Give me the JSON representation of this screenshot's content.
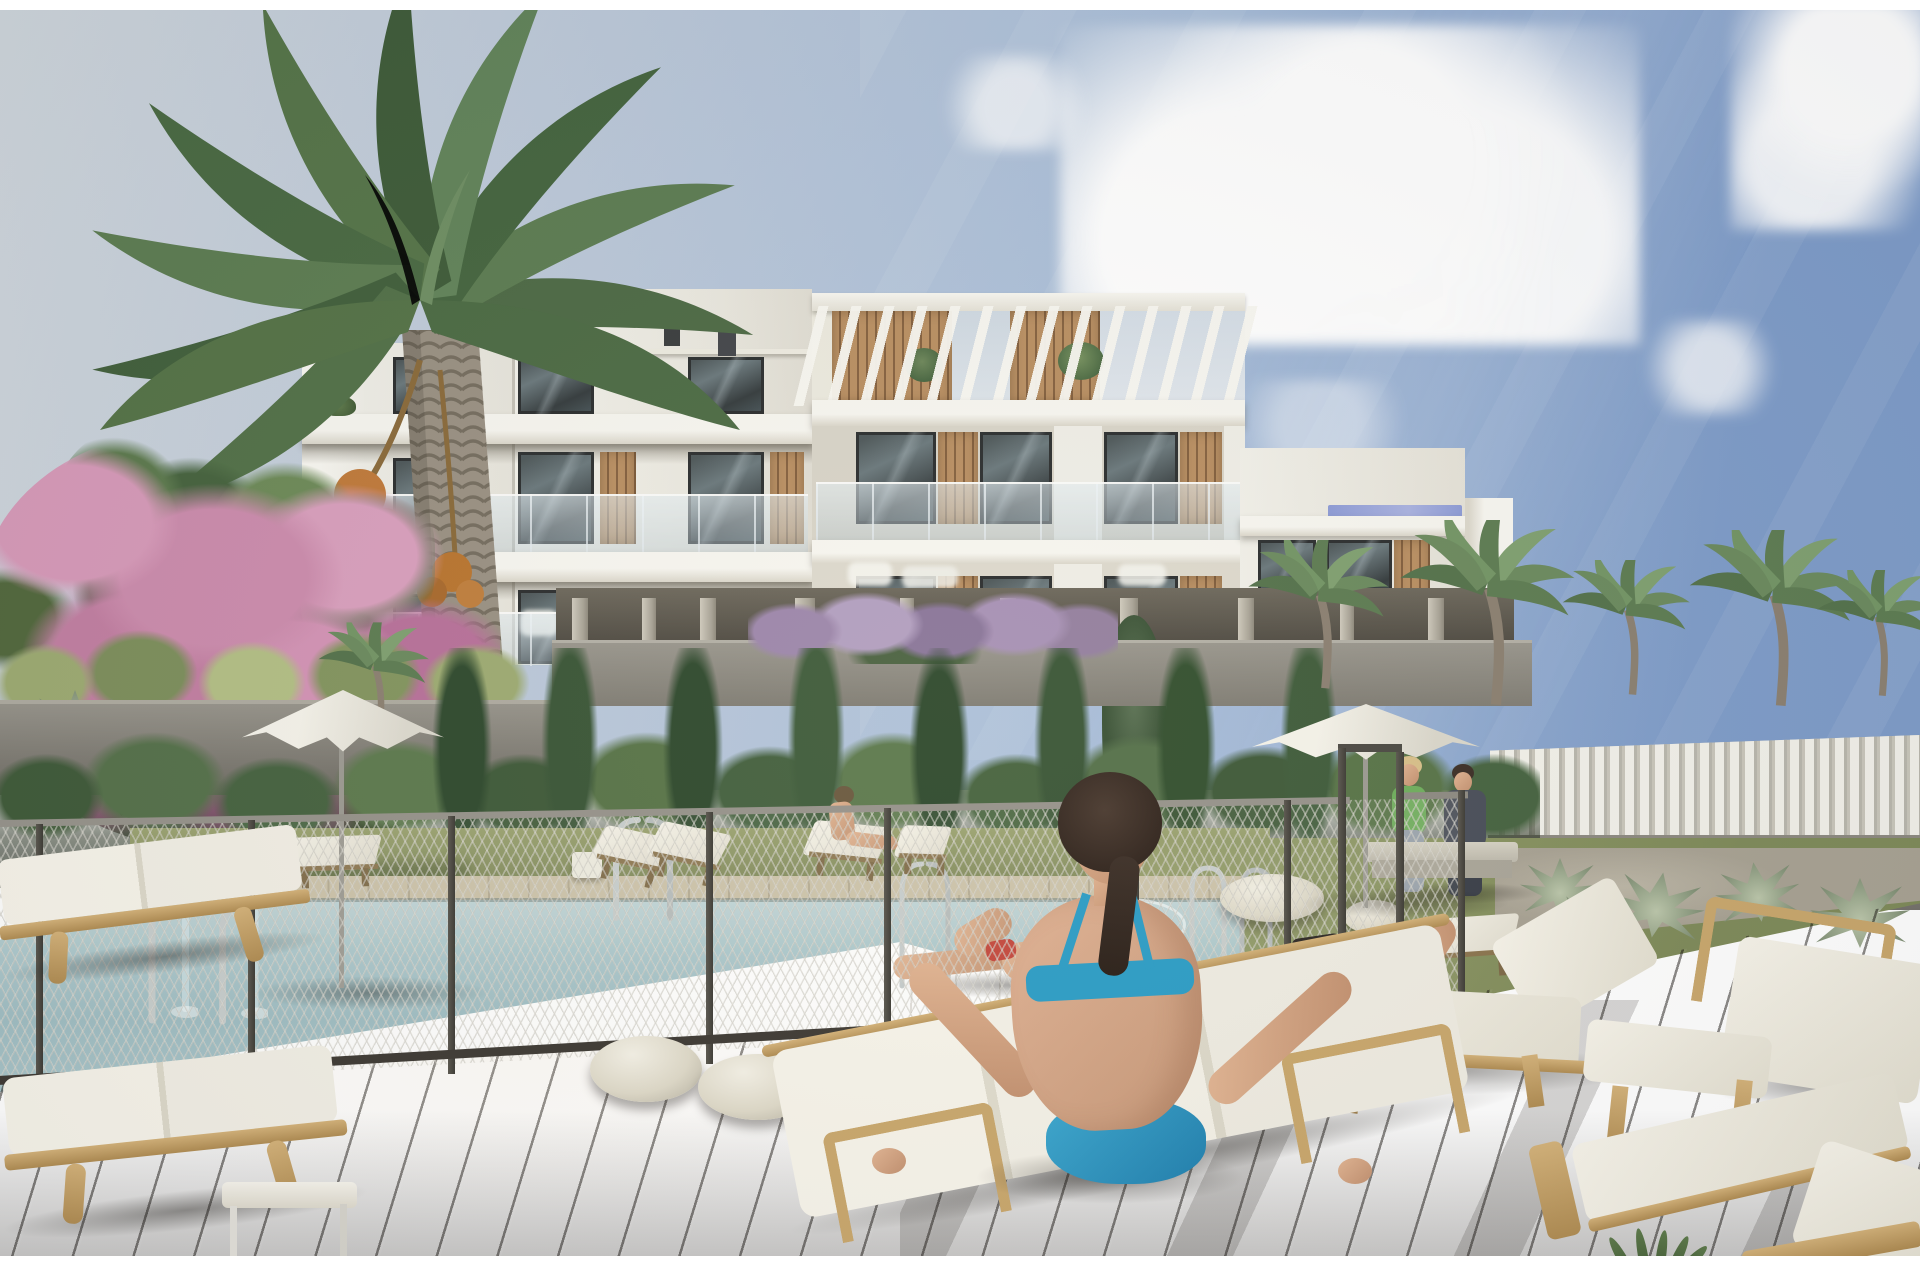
{
  "scene": {
    "type": "architectural-render",
    "setting": "Modern white apartment complex with communal swimming pool, sun deck and gardens under a blue sky",
    "elements": [
      "white apartment building with rooftop pergola, wood-slat panels and glass balconies",
      "tall date palm tree (left)",
      "pink bougainvillea bush",
      "cypress and leafy garden trees",
      "gray retaining walls with agave planters",
      "chain-link pool safety fence with gate",
      "swimming pool with chrome swan-neck fountains and ladder rails",
      "two white parasols",
      "timber sun loungers with white cushions",
      "woven white poufs",
      "dark composite timber deck with diagonal planks",
      "white slatted boundary fence (right)",
      "background palm trees"
    ],
    "people": [
      "woman in blue bikini seated on lounger, back to camera (foreground)",
      "woman in red bikini lying at pool edge",
      "swimmer in pool",
      "woman reclining on lounger wearing headphones (right)",
      "woman seated on lounger by the hedge",
      "couple seated on a bench (background right)"
    ]
  },
  "palette": {
    "white": "#ffffff",
    "sky_left": "#d0d7dd",
    "sky_mid": "#a9bed9",
    "sky_right": "#7e9cc9",
    "building": "#efeee7",
    "building_bright": "#f8f7f1",
    "building_shade": "#d9d5c9",
    "recess": "#d8d4c8",
    "window_frame": "#2b2e2f",
    "wood": "#ab8158",
    "wood_light": "#c9a76c",
    "terrace_glass": "#8d9bd6",
    "foliage_dark": "#3b5233",
    "foliage": "#5c7547",
    "foliage_light": "#82976a",
    "pink": "#d393b5",
    "pink_deep": "#b26f97",
    "trunk": "#968e7e",
    "wall": "#8f8c83",
    "wall_dark": "#6f6c63",
    "lawn": "#8d9565",
    "deck_far": "#cbc2a8",
    "water": "#a3c0c6",
    "water_deep": "#8fb0b8",
    "post": "#4c4a44",
    "deck": "#5d564e",
    "deck_dark": "#49433c",
    "cushion": "#f3f0e6",
    "pouf": "#e7e3d4",
    "umbrella": "#f2f0e7",
    "skin": "#d9ab8c",
    "hair": "#3c2f27",
    "bikini_red": "#c23f35",
    "bikini_blue": "#2c9dc6",
    "chrome": "#c6cccd",
    "green_top": "#6fae5d",
    "shirt": "#494e59"
  }
}
